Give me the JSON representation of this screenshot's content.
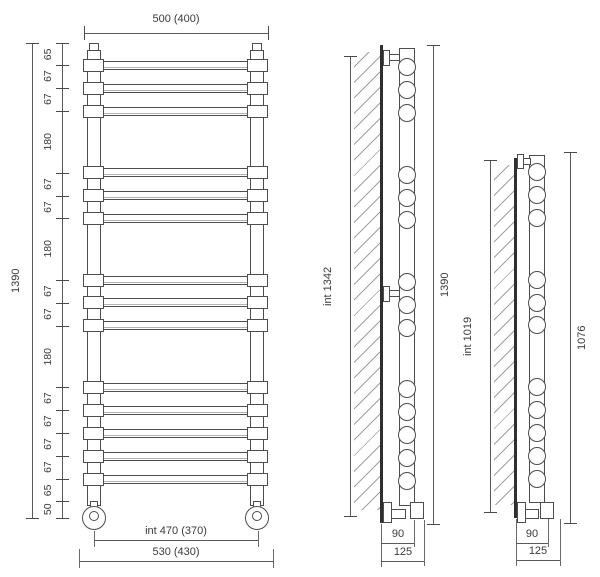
{
  "drawing": {
    "type": "towel-radiator-dimension-drawing",
    "line_color": "#4d4d4d",
    "text_color": "#3a3a3a",
    "front_view": {
      "top_width_label": "500 (400)",
      "overall_height_label": "1390",
      "segments_mm": [
        65,
        67,
        67,
        180,
        67,
        67,
        180,
        67,
        67,
        180,
        67,
        67,
        67,
        67,
        65,
        50
      ],
      "bar_count": 14,
      "inner_width_label": "int 470 (370)",
      "overall_width_label": "530 (430)"
    },
    "side_view_tall": {
      "inner_height_label": "int 1342",
      "overall_height_label": "1390",
      "rung_count": 14,
      "rung_positions_mm": [
        65,
        132,
        199,
        379,
        446,
        513,
        693,
        760,
        827,
        1007,
        1074,
        1141,
        1208,
        1275
      ],
      "wall_offset_label": "90",
      "overall_depth_label": "125"
    },
    "side_view_short": {
      "inner_height_label": "int 1019",
      "overall_height_label": "1076",
      "rung_count": 11,
      "rung_positions_mm": [
        65,
        132,
        199,
        379,
        446,
        513,
        693,
        760,
        827,
        894,
        961
      ],
      "wall_offset_label": "90",
      "overall_depth_label": "125"
    }
  }
}
